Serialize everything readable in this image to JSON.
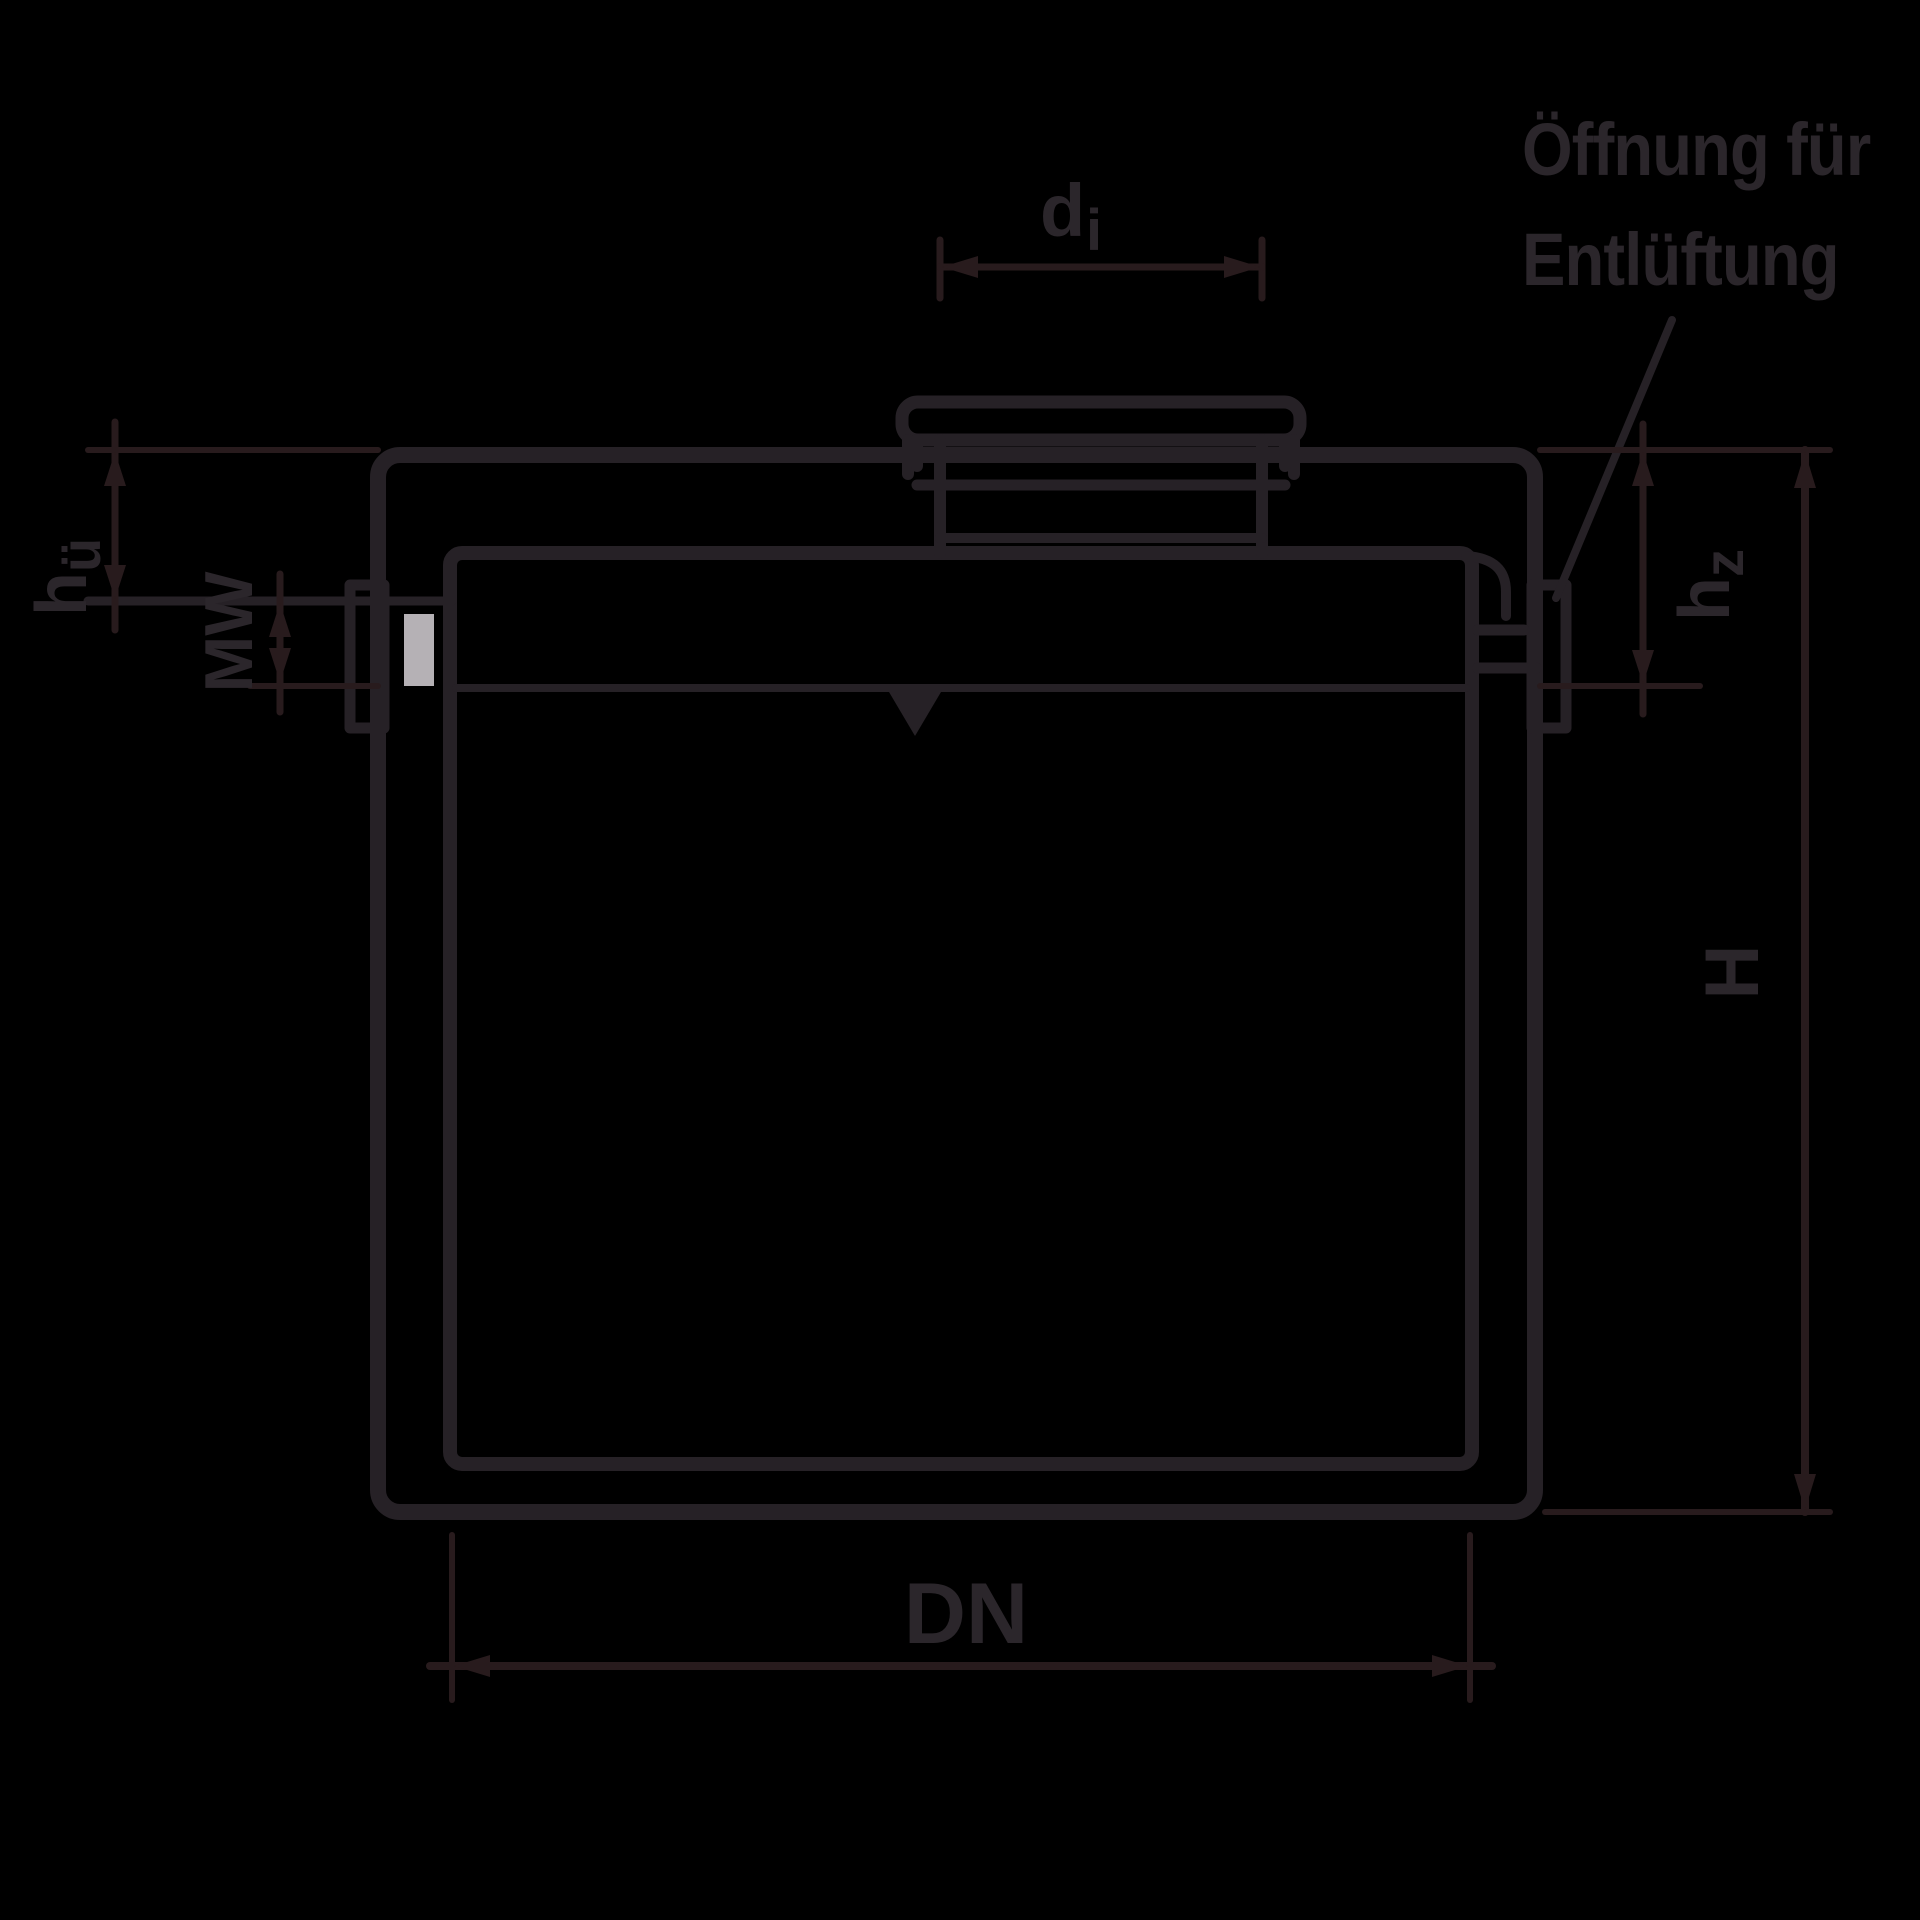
{
  "drawing": {
    "annotation": {
      "line1": "Öffnung für",
      "line2": "Entlüftung"
    },
    "labels": {
      "di": {
        "main": "d",
        "sub": "i"
      },
      "hue": {
        "main": "h",
        "sub": "ü"
      },
      "mw": "MW",
      "hz": {
        "main": "h",
        "sub": "z"
      },
      "h": "H",
      "dn": "DN"
    },
    "colors": {
      "background": "#000000",
      "line": "#262126",
      "dimension_line": "#281b1d",
      "text": "#2b262b",
      "seal_slot": "#b5b1b5"
    }
  }
}
